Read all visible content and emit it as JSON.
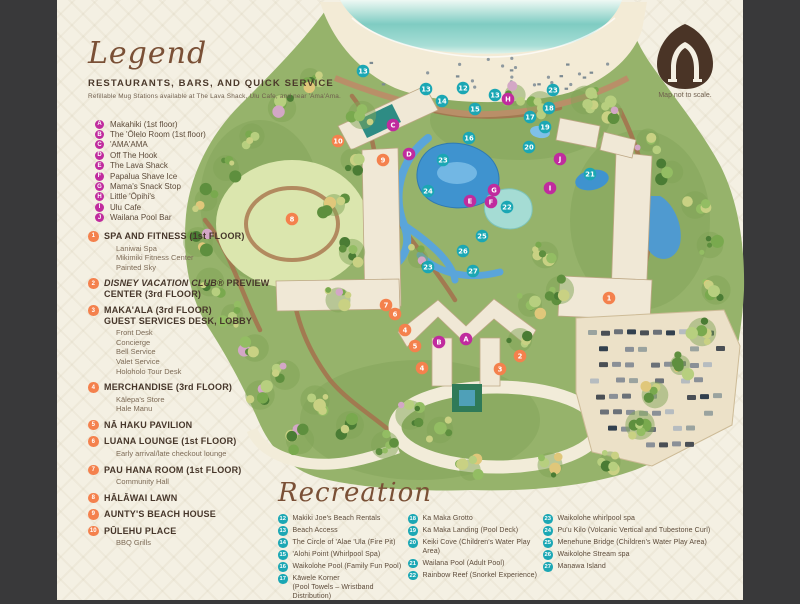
{
  "colors": {
    "magenta": "#c02b9e",
    "orange": "#f4814d",
    "teal": "#1ba7b4",
    "background": "#f4f0e3",
    "side_bars": "#39393a",
    "logo_brown": "#4a3426"
  },
  "legend": {
    "title": "Legend",
    "section_title": "RESTAURANTS, BARS, AND QUICK SERVICE",
    "note": "Refillable Mug Stations available at The Lava Shack, Ulu Cafe, and near 'Ama'Ama.",
    "restaurants": [
      {
        "letter": "A",
        "label": "Makahiki (1st floor)"
      },
      {
        "letter": "B",
        "label": "The 'Ōlelo Room (1st floor)"
      },
      {
        "letter": "C",
        "label": "'AMA'AMA"
      },
      {
        "letter": "D",
        "label": "Off The Hook"
      },
      {
        "letter": "E",
        "label": "The Lava Shack"
      },
      {
        "letter": "F",
        "label": "Papalua Shave Ice"
      },
      {
        "letter": "G",
        "label": "Mama's Snack Stop"
      },
      {
        "letter": "H",
        "label": "Little 'Ōpihi's"
      },
      {
        "letter": "I",
        "label": "Ulu Cafe"
      },
      {
        "letter": "J",
        "label": "Wailana Pool Bar"
      }
    ],
    "facilities": [
      {
        "num": "1",
        "title": "SPA AND FITNESS (1st FLOOR)",
        "subs": [
          "Laniwai Spa",
          "Mikimiki Fitness Center",
          "Painted Sky"
        ]
      },
      {
        "num": "2",
        "title_italic": "DISNEY VACATION CLUB®",
        "title": "PREVIEW\nCENTER (3rd FLOOR)",
        "subs": []
      },
      {
        "num": "3",
        "title": "MAKA'ALA (3rd FLOOR)\nGUEST SERVICES DESK, LOBBY",
        "subs": [
          "Front Desk",
          "Concierge",
          "Bell Service",
          "Valet Service",
          "Holoholo Tour Desk"
        ]
      },
      {
        "num": "4",
        "title": "MERCHANDISE (3rd FLOOR)",
        "subs": [
          "Kālepa's Store",
          "Hale Manu"
        ]
      },
      {
        "num": "5",
        "title": "NĀ HAKU PAVILION",
        "subs": []
      },
      {
        "num": "6",
        "title": "LUANA LOUNGE (1st FLOOR)",
        "subs": [
          "Early arrival/late checkout lounge"
        ]
      },
      {
        "num": "7",
        "title": "PAU HANA ROOM (1st FLOOR)",
        "subs": [
          "Community Hall"
        ]
      },
      {
        "num": "8",
        "title": "HĀLĀWAI LAWN",
        "subs": []
      },
      {
        "num": "9",
        "title": "AUNTY'S BEACH HOUSE",
        "subs": []
      },
      {
        "num": "10",
        "title": "PŪLEHU PLACE",
        "subs": [
          "BBQ Grills"
        ]
      }
    ]
  },
  "recreation": {
    "title": "Recreation",
    "columns": [
      [
        {
          "num": "12",
          "label": "Makiki Joe's Beach Rentals"
        },
        {
          "num": "13",
          "label": "Beach Access"
        },
        {
          "num": "14",
          "label": "The Circle of 'Alae 'Ula (Fire Pit)"
        },
        {
          "num": "15",
          "label": "'Alohi Point (Whirlpool Spa)"
        },
        {
          "num": "16",
          "label": "Waikolohe Pool (Family Fun Pool)"
        },
        {
          "num": "17",
          "label": "Kāwele Korner\n(Pool Towels – Wristband Distribution)"
        }
      ],
      [
        {
          "num": "18",
          "label": "Ka Maka Grotto"
        },
        {
          "num": "19",
          "label": "Ka Maka Landing (Pool Deck)"
        },
        {
          "num": "20",
          "label": "Keiki Cove (Children's Water Play Area)"
        },
        {
          "num": "21",
          "label": "Wailana Pool (Adult Pool)"
        },
        {
          "num": "22",
          "label": "Rainbow Reef (Snorkel Experience)"
        }
      ],
      [
        {
          "num": "23",
          "label": "Waikolohe whirlpool spa"
        },
        {
          "num": "24",
          "label": "Pu'u Kilo (Volcanic Vertical and Tubestone Curl)"
        },
        {
          "num": "25",
          "label": "Menehune Bridge (Children's Water Play Area)"
        },
        {
          "num": "26",
          "label": "Waikolohe Stream spa"
        },
        {
          "num": "27",
          "label": "Manawa Island"
        }
      ]
    ]
  },
  "map_note": "Map not to scale.",
  "map_markers": [
    {
      "type": "letter",
      "label": "A",
      "x": 466,
      "y": 339
    },
    {
      "type": "letter",
      "label": "B",
      "x": 439,
      "y": 342
    },
    {
      "type": "letter",
      "label": "C",
      "x": 393,
      "y": 125
    },
    {
      "type": "letter",
      "label": "D",
      "x": 409,
      "y": 154
    },
    {
      "type": "letter",
      "label": "E",
      "x": 470,
      "y": 201
    },
    {
      "type": "letter",
      "label": "F",
      "x": 491,
      "y": 202
    },
    {
      "type": "letter",
      "label": "G",
      "x": 494,
      "y": 190
    },
    {
      "type": "letter",
      "label": "H",
      "x": 508,
      "y": 99
    },
    {
      "type": "letter",
      "label": "I",
      "x": 550,
      "y": 188
    },
    {
      "type": "letter",
      "label": "J",
      "x": 560,
      "y": 159
    },
    {
      "type": "facility",
      "label": "1",
      "x": 609,
      "y": 298
    },
    {
      "type": "facility",
      "label": "2",
      "x": 520,
      "y": 356
    },
    {
      "type": "facility",
      "label": "3",
      "x": 500,
      "y": 369
    },
    {
      "type": "facility",
      "label": "4",
      "x": 405,
      "y": 330
    },
    {
      "type": "facility",
      "label": "4",
      "x": 422,
      "y": 368
    },
    {
      "type": "facility",
      "label": "5",
      "x": 415,
      "y": 346
    },
    {
      "type": "facility",
      "label": "6",
      "x": 395,
      "y": 314
    },
    {
      "type": "facility",
      "label": "7",
      "x": 386,
      "y": 305
    },
    {
      "type": "facility",
      "label": "8",
      "x": 292,
      "y": 219
    },
    {
      "type": "facility",
      "label": "9",
      "x": 383,
      "y": 160
    },
    {
      "type": "facility",
      "label": "10",
      "x": 338,
      "y": 141
    },
    {
      "type": "recreation",
      "label": "12",
      "x": 463,
      "y": 88
    },
    {
      "type": "recreation",
      "label": "13",
      "x": 363,
      "y": 71
    },
    {
      "type": "recreation",
      "label": "13",
      "x": 426,
      "y": 89
    },
    {
      "type": "recreation",
      "label": "13",
      "x": 495,
      "y": 95
    },
    {
      "type": "recreation",
      "label": "14",
      "x": 442,
      "y": 101
    },
    {
      "type": "recreation",
      "label": "15",
      "x": 475,
      "y": 109
    },
    {
      "type": "recreation",
      "label": "16",
      "x": 469,
      "y": 138
    },
    {
      "type": "recreation",
      "label": "17",
      "x": 530,
      "y": 117
    },
    {
      "type": "recreation",
      "label": "18",
      "x": 549,
      "y": 108
    },
    {
      "type": "recreation",
      "label": "19",
      "x": 545,
      "y": 127
    },
    {
      "type": "recreation",
      "label": "20",
      "x": 529,
      "y": 147
    },
    {
      "type": "recreation",
      "label": "21",
      "x": 590,
      "y": 174
    },
    {
      "type": "recreation",
      "label": "22",
      "x": 507,
      "y": 207
    },
    {
      "type": "recreation",
      "label": "23",
      "x": 553,
      "y": 90
    },
    {
      "type": "recreation",
      "label": "23",
      "x": 443,
      "y": 160
    },
    {
      "type": "recreation",
      "label": "23",
      "x": 428,
      "y": 267
    },
    {
      "type": "recreation",
      "label": "24",
      "x": 428,
      "y": 191
    },
    {
      "type": "recreation",
      "label": "25",
      "x": 482,
      "y": 236
    },
    {
      "type": "recreation",
      "label": "26",
      "x": 463,
      "y": 251
    },
    {
      "type": "recreation",
      "label": "27",
      "x": 473,
      "y": 271
    }
  ]
}
